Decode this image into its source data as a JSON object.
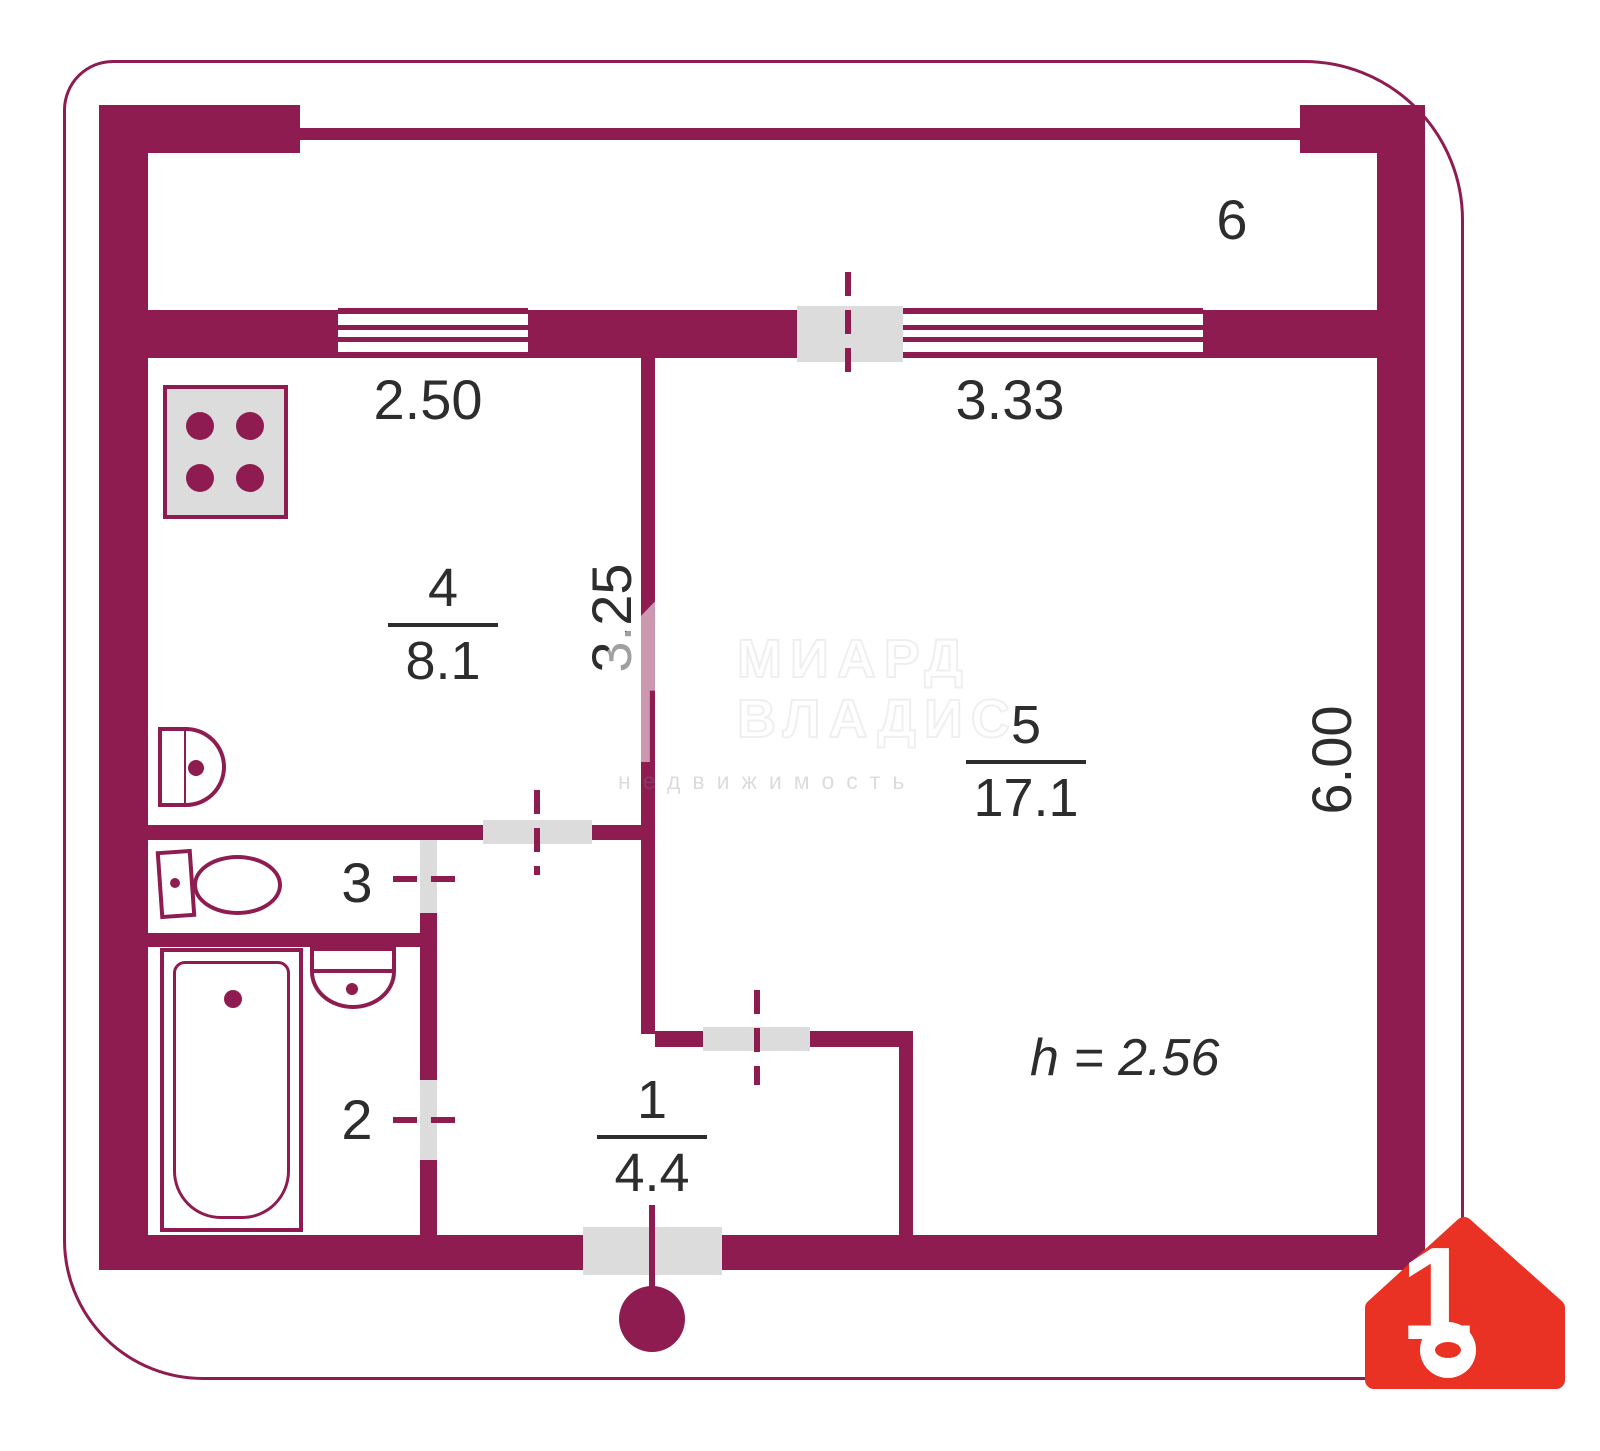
{
  "colors": {
    "wall": "#8e1c50",
    "door": "#dcdcdc",
    "text": "#2d2d2d",
    "logo": "#e93223"
  },
  "rooms": {
    "balcony": {
      "label": "6"
    },
    "kitchen": {
      "number": "4",
      "area": "8.1"
    },
    "living": {
      "number": "5",
      "area": "17.1"
    },
    "hall": {
      "number": "1",
      "area": "4.4"
    },
    "wc": {
      "label": "3"
    },
    "bathroom": {
      "label": "2"
    }
  },
  "dimensions": {
    "kitchen_width": "2.50",
    "living_width": "3.33",
    "kitchen_depth": "3.25",
    "living_depth": "6.00",
    "ceiling_height": "h = 2.56"
  },
  "watermark": {
    "line1": "МИАРД",
    "line2": "ВЛАДИС",
    "line3": "недвижимость"
  },
  "logo": {
    "number": "1"
  }
}
